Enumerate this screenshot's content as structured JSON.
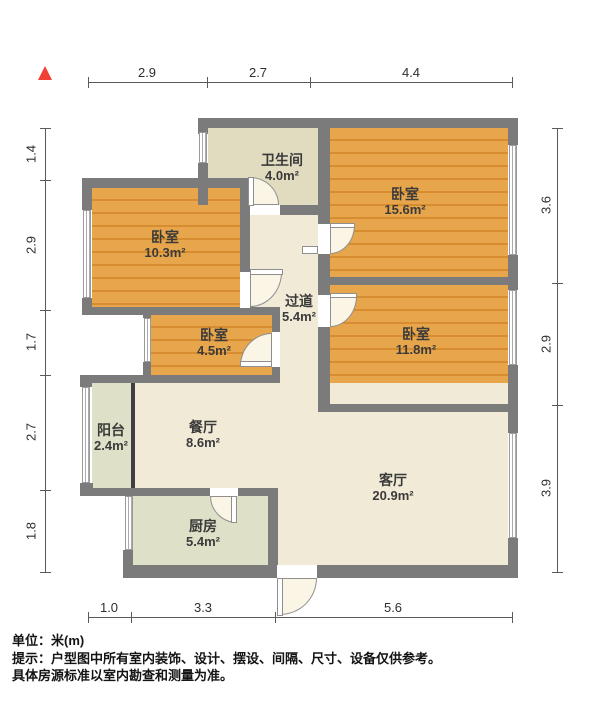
{
  "plan": {
    "north_marker": "north-arrow",
    "wall_color": "#7b7b7b",
    "bedroom_floor_color": "#e29a3d",
    "hall_floor_color": "#f1ead6",
    "bath_floor_color": "#e1dbc0",
    "kitchen_floor_color": "#dfe0c8",
    "north_marker_color": "#ef4136"
  },
  "rooms": [
    {
      "name": "卫生间",
      "area": "4.0m²"
    },
    {
      "name": "卧室",
      "area": "15.6m²"
    },
    {
      "name": "卧室",
      "area": "10.3m²"
    },
    {
      "name": "过道",
      "area": "5.4m²"
    },
    {
      "name": "卧室",
      "area": "4.5m²"
    },
    {
      "name": "卧室",
      "area": "11.8m²"
    },
    {
      "name": "阳台",
      "area": "2.4m²"
    },
    {
      "name": "餐厅",
      "area": "8.6m²"
    },
    {
      "name": "客厅",
      "area": "20.9m²"
    },
    {
      "name": "厨房",
      "area": "5.4m²"
    }
  ],
  "dimensions": {
    "top": [
      "2.9",
      "2.7",
      "4.4"
    ],
    "left": [
      "1.4",
      "2.9",
      "1.7",
      "2.7",
      "1.8"
    ],
    "right": [
      "3.6",
      "2.9",
      "3.9"
    ],
    "bottom": [
      "1.0",
      "3.3",
      "5.6"
    ]
  },
  "footer": {
    "line1": "单位：米(m)",
    "line2": "提示：户型图中所有室内装饰、设计、摆设、间隔、尺寸、设备仅供参考。",
    "line3": "具体房源标准以室内勘查和测量为准。"
  },
  "watermark": "Q房网"
}
